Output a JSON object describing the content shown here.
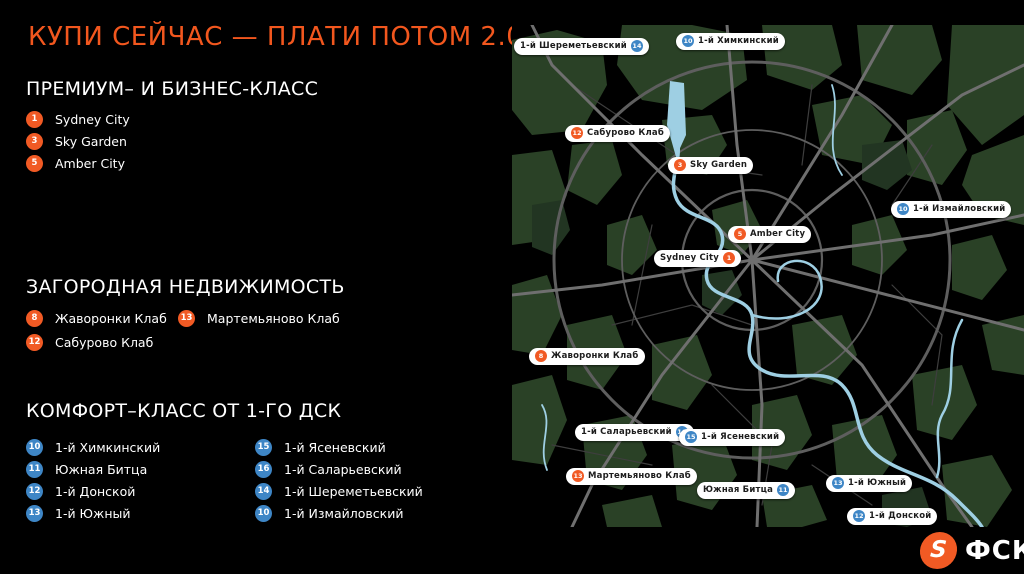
{
  "slide": {
    "title": "КУПИ СЕЙЧАС — ПЛАТИ ПОТОМ 2.0"
  },
  "colors": {
    "accent_orange": "#F2571E",
    "badge_orange": "#F15A24",
    "badge_blue": "#3E86C6",
    "map_green": "#2A4126",
    "map_road": "#6F6F6F",
    "map_river": "#9ECFE3"
  },
  "sections": {
    "premium": {
      "heading": "ПРЕМИУМ– И БИЗНЕС-КЛАСС",
      "items": [
        {
          "number": "1",
          "label": "Sydney City"
        },
        {
          "number": "3",
          "label": "Sky Garden"
        },
        {
          "number": "5",
          "label": "Amber City"
        }
      ]
    },
    "suburban": {
      "heading": "ЗАГОРОДНАЯ НЕДВИЖИМОСТЬ",
      "col1": [
        {
          "number": "8",
          "label": "Жаворонки Клаб"
        },
        {
          "number": "12",
          "label": "Сабурово Клаб"
        }
      ],
      "col2": [
        {
          "number": "13",
          "label": "Мартемьяново Клаб"
        }
      ]
    },
    "comfort": {
      "heading": "КОМФОРТ–КЛАСС ОТ 1-ГО ДСК",
      "col1": [
        {
          "number": "10",
          "label": "1-й Химкинский"
        },
        {
          "number": "11",
          "label": "Южная Битца"
        },
        {
          "number": "12",
          "label": "1-й Донской"
        },
        {
          "number": "13",
          "label": "1-й Южный"
        }
      ],
      "col2": [
        {
          "number": "15",
          "label": "1-й Ясеневский"
        },
        {
          "number": "16",
          "label": "1-й Саларьевский"
        },
        {
          "number": "14",
          "label": "1-й Шереметьевский"
        },
        {
          "number": "10",
          "label": "1-й Измайловский"
        }
      ]
    }
  },
  "map": {
    "pins": [
      {
        "label": "1-й Шереметьевский",
        "number": "14"
      },
      {
        "label": "1-й Химкинский",
        "number": "10"
      },
      {
        "label": "Сабурово Клаб",
        "number": "12"
      },
      {
        "label": "Sky Garden",
        "number": "3"
      },
      {
        "label": "1-й Измайловский",
        "number": "10"
      },
      {
        "label": "Amber City",
        "number": "5"
      },
      {
        "label": "Sydney City",
        "number": "1"
      },
      {
        "label": "Жаворонки Клаб",
        "number": "8"
      },
      {
        "label": "1-й Саларьевский",
        "number": "16"
      },
      {
        "label": "1-й Ясеневский",
        "number": "15"
      },
      {
        "label": "Мартемьяново Клаб",
        "number": "13"
      },
      {
        "label": "Южная Битца",
        "number": "11"
      },
      {
        "label": "1-й Южный",
        "number": "13"
      },
      {
        "label": "1-й Донской",
        "number": "12"
      }
    ]
  },
  "logo": {
    "mark": "S",
    "text": "ФСК"
  }
}
